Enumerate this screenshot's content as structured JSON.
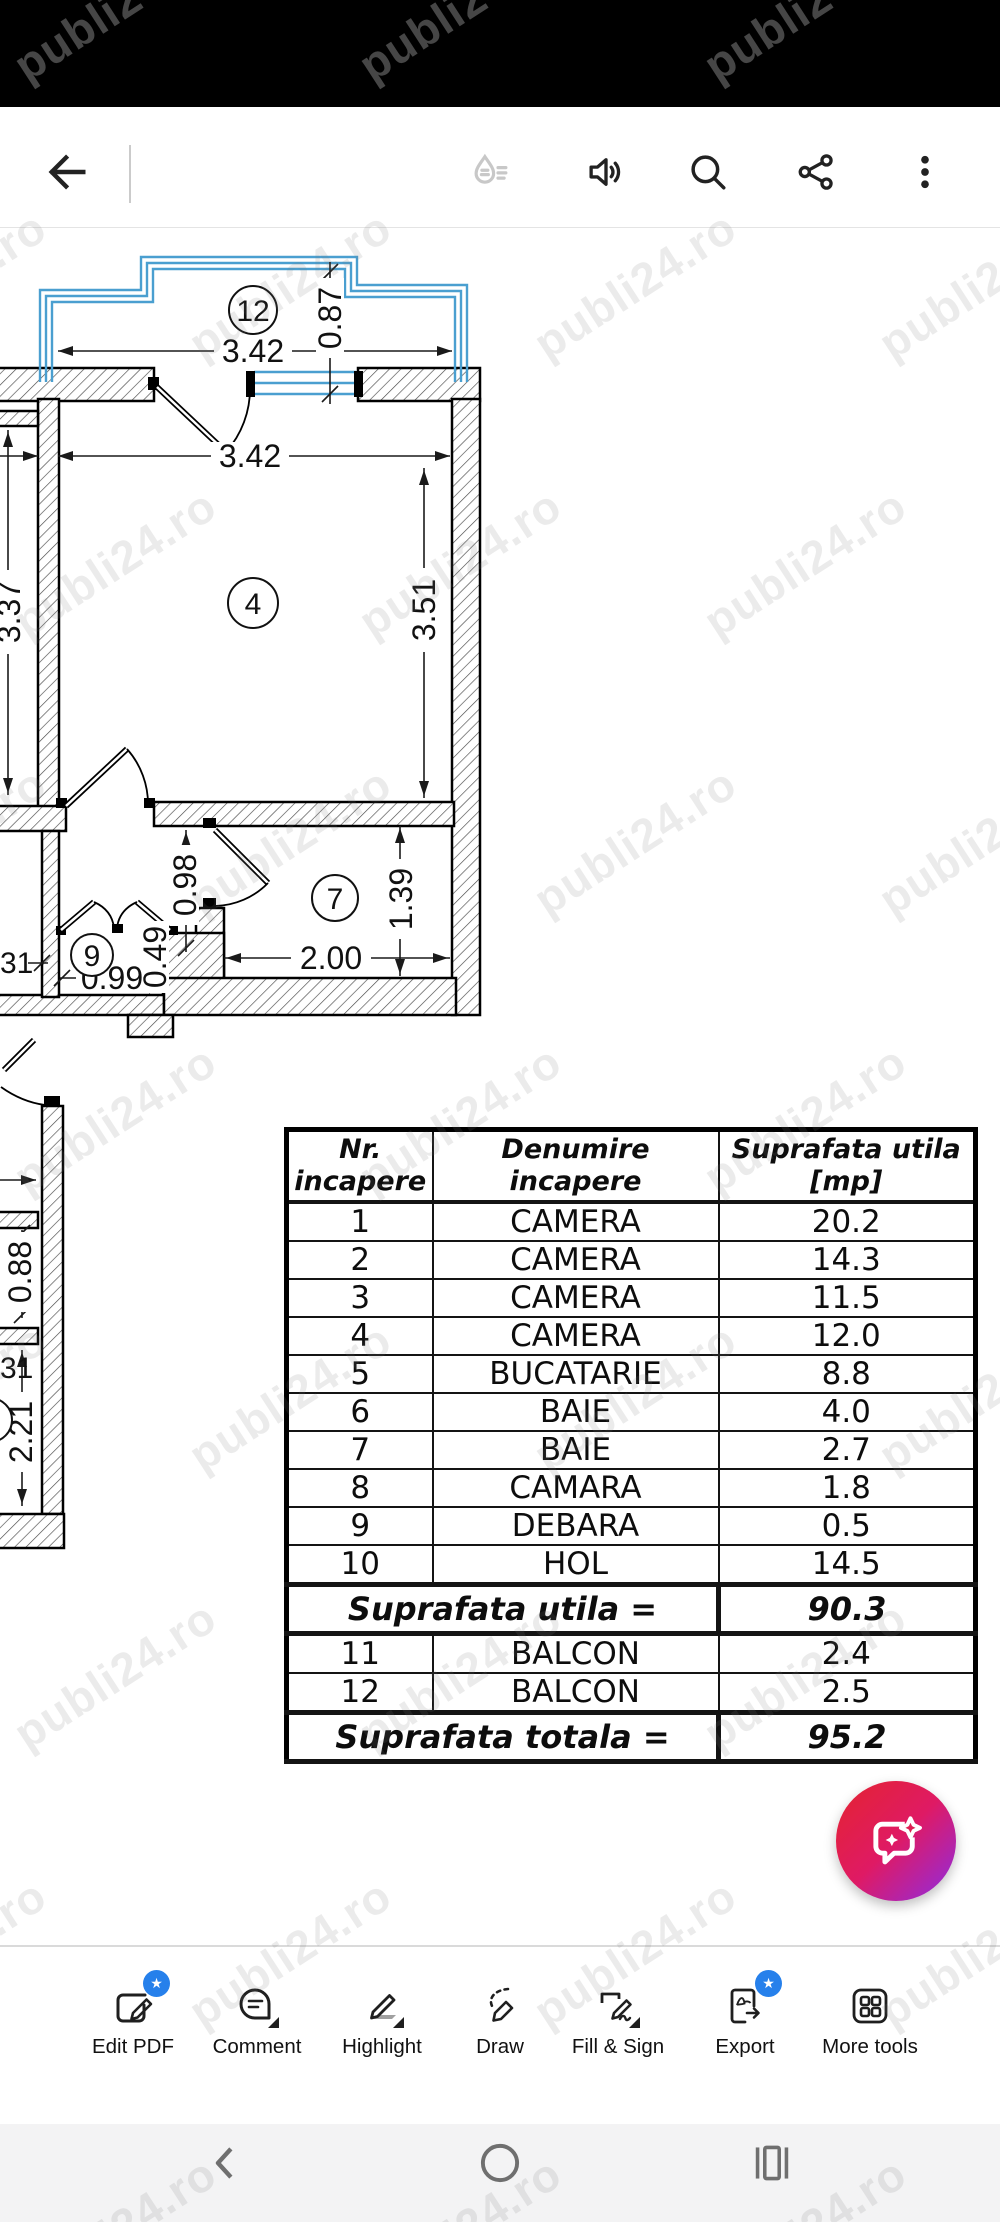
{
  "watermark": {
    "text": "publi24.ro"
  },
  "toolbar": {
    "back_icon": "back-arrow-icon",
    "icons": [
      {
        "name": "liquid-mode-icon",
        "enabled": false
      },
      {
        "name": "read-aloud-icon",
        "enabled": true
      },
      {
        "name": "search-icon",
        "enabled": true
      },
      {
        "name": "share-icon",
        "enabled": true
      },
      {
        "name": "overflow-menu-icon",
        "enabled": true
      }
    ]
  },
  "plan": {
    "rooms": {
      "balcony": "12",
      "camera": "4",
      "bath": "7",
      "debara": "9"
    },
    "dims": {
      "balcony_width": "3.42",
      "balcony_depth": "0.87",
      "room_width": "3.42",
      "room_height": "3.51",
      "left_room_height": "3.37",
      "hall_opening": "0.98",
      "bath_depth": "1.39",
      "bath_width": "2.00",
      "closet_width": "0.99",
      "closet_depth": "0.49",
      "left_cut_top": "31",
      "left_window": "0.88",
      "left_cut_bottom": "31",
      "left_wall_height": "2.21"
    },
    "window_color": "#4a9fd0"
  },
  "table": {
    "headers": {
      "col1": "Nr. incapere",
      "col2": "Denumire incapere",
      "col3": "Suprafata utila [mp]"
    },
    "rows": [
      {
        "nr": "1",
        "name": "CAMERA",
        "area": "20.2"
      },
      {
        "nr": "2",
        "name": "CAMERA",
        "area": "14.3"
      },
      {
        "nr": "3",
        "name": "CAMERA",
        "area": "11.5"
      },
      {
        "nr": "4",
        "name": "CAMERA",
        "area": "12.0"
      },
      {
        "nr": "5",
        "name": "BUCATARIE",
        "area": "8.8"
      },
      {
        "nr": "6",
        "name": "BAIE",
        "area": "4.0"
      },
      {
        "nr": "7",
        "name": "BAIE",
        "area": "2.7"
      },
      {
        "nr": "8",
        "name": "CAMARA",
        "area": "1.8"
      },
      {
        "nr": "9",
        "name": "DEBARA",
        "area": "0.5"
      },
      {
        "nr": "10",
        "name": "HOL",
        "area": "14.5"
      }
    ],
    "subtotal": {
      "label": "Suprafata utila =",
      "value": "90.3"
    },
    "rows2": [
      {
        "nr": "11",
        "name": "BALCON",
        "area": "2.4"
      },
      {
        "nr": "12",
        "name": "BALCON",
        "area": "2.5"
      }
    ],
    "total": {
      "label": "Suprafata totala =",
      "value": "95.2"
    }
  },
  "fab": {
    "icon": "ai-assistant-chat-icon",
    "gradient": [
      "#e4242f",
      "#df1a64",
      "#8d2ce4"
    ]
  },
  "bottom_toolbar": {
    "items": [
      {
        "label": "Edit PDF",
        "icon": "edit-pdf-icon",
        "badge": true,
        "submenu": false
      },
      {
        "label": "Comment",
        "icon": "comment-icon",
        "badge": false,
        "submenu": true
      },
      {
        "label": "Highlight",
        "icon": "highlight-icon",
        "badge": false,
        "submenu": true
      },
      {
        "label": "Draw",
        "icon": "draw-icon",
        "badge": false,
        "submenu": false
      },
      {
        "label": "Fill & Sign",
        "icon": "fill-sign-icon",
        "badge": false,
        "submenu": true
      },
      {
        "label": "Export",
        "icon": "export-icon",
        "badge": true,
        "submenu": false
      },
      {
        "label": "More tools",
        "icon": "more-tools-icon",
        "badge": false,
        "submenu": false
      }
    ]
  },
  "nav_bar": {
    "icons": [
      "back-chevron-icon",
      "home-circle-icon",
      "recents-icon"
    ]
  },
  "colors": {
    "badge_blue": "#2680eb",
    "window_blue": "#4a9fd0",
    "nav_bg": "#f3f3f4",
    "status_bg": "#000000"
  }
}
